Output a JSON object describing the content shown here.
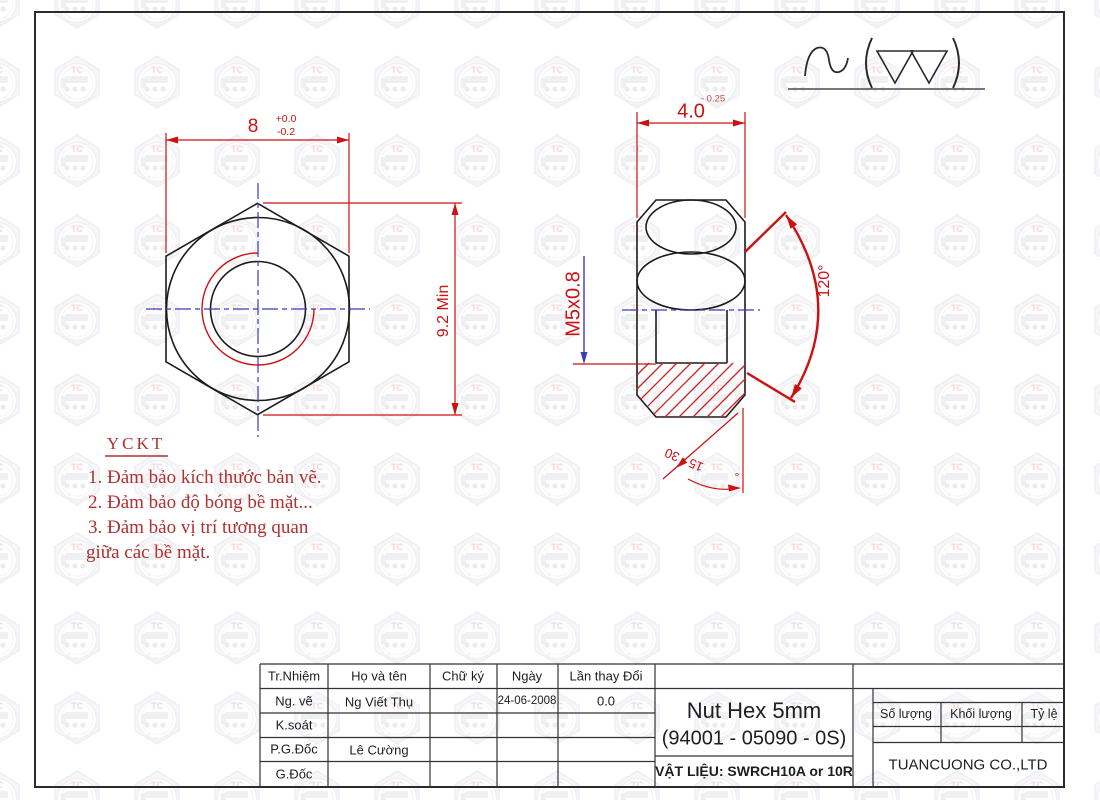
{
  "colors": {
    "dim_red": "#cc1111",
    "centerline_blue": "#3c3cb4",
    "note_red": "#b03030",
    "line_black": "#1c1c1c"
  },
  "watermark": {
    "text": "TC"
  },
  "front_view": {
    "width_value": "8",
    "width_tol_upper": "+0.0",
    "width_tol_lower": "-0.2",
    "height_value": "9.2 Min"
  },
  "side_view": {
    "thickness_value": "4.0",
    "thickness_tol": "- 0.25",
    "thread_label": "M5x0.8",
    "angle_value": "120°",
    "chamfer_range": "15 - 30",
    "chamfer_degree": "°"
  },
  "notes": {
    "title": "YCKT",
    "lines": [
      "1. Đảm bảo kích thước bản vẽ.",
      "2. Đảm bảo độ bóng bề mặt...",
      "3. Đảm bảo vị trí tương quan",
      "giữa các bề mặt."
    ]
  },
  "title_block": {
    "headers": {
      "role": "Tr.Nhiệm",
      "name": "Họ và tên",
      "signature": "Chữ ký",
      "date": "Ngày",
      "revision": "Lần thay Đổi"
    },
    "rows": [
      {
        "role": "Ng. vẽ",
        "name": "Ng Viết Thụ",
        "date": "24-06-2008",
        "revision": "0.0"
      },
      {
        "role": "K.soát",
        "name": "",
        "date": "",
        "revision": ""
      },
      {
        "role": "P.G.Đốc",
        "name": "Lê Cường",
        "date": "",
        "revision": ""
      },
      {
        "role": "G.Đốc",
        "name": "",
        "date": "",
        "revision": ""
      }
    ],
    "part_title": "Nut Hex 5mm",
    "part_number": "(94001 - 05090 - 0S)",
    "material": "VẬT LIỆU: SWRCH10A or 10R",
    "qty_label": "Số lượng",
    "weight_label": "Khối lượng",
    "scale_label": "Tỷ lệ",
    "company": "TUANCUONG CO.,LTD"
  }
}
